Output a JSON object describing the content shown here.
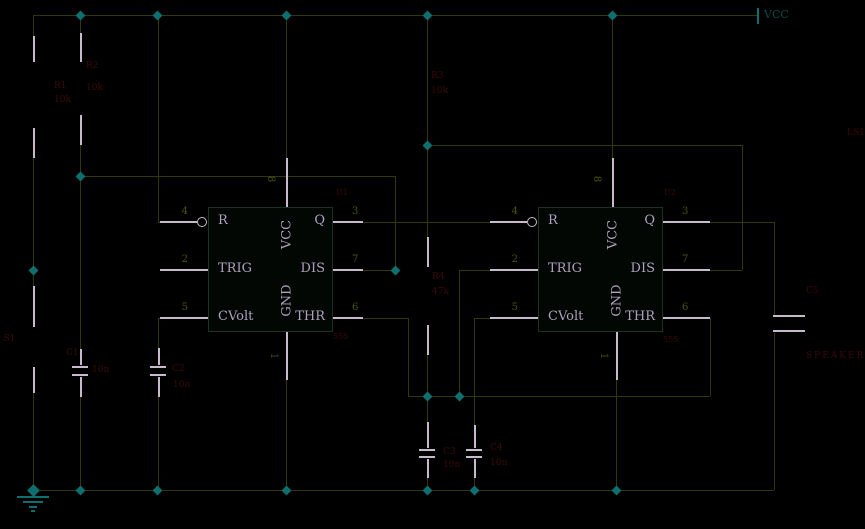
{
  "canvas": {
    "width": 865,
    "height": 529,
    "background": "#000000"
  },
  "colors": {
    "wire": "#2f3a06",
    "lead": "#c8b9cd",
    "teal": "#0f6e6e",
    "red": "#3c0a05",
    "num": "#4a5509",
    "pin_text": "#afa0be",
    "vcc_text": "#0a4b4b",
    "chip_border": "#193223",
    "chip_fill": "#020703"
  },
  "power": {
    "vcc_label": "VCC"
  },
  "chips": [
    {
      "ref": "U1",
      "value": "555",
      "x": 208,
      "y": 207,
      "w": 125,
      "h": 125,
      "left_pins": [
        {
          "num": "4",
          "name": "R",
          "y": 222
        },
        {
          "num": "2",
          "name": "TRIG",
          "y": 270
        },
        {
          "num": "5",
          "name": "CVolt",
          "y": 318
        }
      ],
      "right_pins": [
        {
          "num": "3",
          "name": "Q",
          "y": 222
        },
        {
          "num": "7",
          "name": "DIS",
          "y": 270
        },
        {
          "num": "6",
          "name": "THR",
          "y": 318
        }
      ],
      "top_pin": {
        "num": "8",
        "name": "VCC",
        "x": 286
      },
      "bottom_pin": {
        "num": "1",
        "name": "GND",
        "x": 286
      },
      "ref_pos": [
        336,
        189
      ],
      "value_pos": [
        333,
        333
      ]
    },
    {
      "ref": "U2",
      "value": "555",
      "x": 538,
      "y": 207,
      "w": 125,
      "h": 125,
      "left_pins": [
        {
          "num": "4",
          "name": "R",
          "y": 222
        },
        {
          "num": "2",
          "name": "TRIG",
          "y": 270
        },
        {
          "num": "5",
          "name": "CVolt",
          "y": 318
        }
      ],
      "right_pins": [
        {
          "num": "3",
          "name": "Q",
          "y": 222
        },
        {
          "num": "7",
          "name": "DIS",
          "y": 270
        },
        {
          "num": "6",
          "name": "THR",
          "y": 318
        }
      ],
      "top_pin": {
        "num": "8",
        "name": "VCC",
        "x": 612
      },
      "bottom_pin": {
        "num": "1",
        "name": "GND",
        "x": 616
      },
      "ref_pos": [
        664,
        189
      ],
      "value_pos": [
        663,
        336
      ]
    }
  ],
  "bubbles": [
    [
      202,
      222
    ],
    [
      532,
      222
    ]
  ],
  "segments": {
    "wire": [
      [
        33,
        15,
        757,
        15
      ],
      [
        33,
        15,
        33,
        36
      ],
      [
        33,
        158,
        33,
        286
      ],
      [
        33,
        393,
        33,
        490
      ],
      [
        80,
        15,
        80,
        33
      ],
      [
        80,
        145,
        80,
        349
      ],
      [
        80,
        397,
        80,
        490
      ],
      [
        80,
        176,
        395,
        176
      ],
      [
        395,
        176,
        395,
        270
      ],
      [
        158,
        15,
        158,
        222
      ],
      [
        158,
        222,
        160,
        222
      ],
      [
        158,
        318,
        160,
        318
      ],
      [
        158,
        318,
        158,
        348
      ],
      [
        158,
        397,
        158,
        490
      ],
      [
        286,
        15,
        286,
        158
      ],
      [
        286,
        380,
        286,
        490
      ],
      [
        427,
        15,
        427,
        237
      ],
      [
        427,
        355,
        427,
        422
      ],
      [
        427,
        478,
        427,
        490
      ],
      [
        427,
        145,
        742,
        145
      ],
      [
        742,
        145,
        742,
        270
      ],
      [
        710,
        270,
        742,
        270
      ],
      [
        363,
        222,
        490,
        222
      ],
      [
        363,
        270,
        395,
        270
      ],
      [
        363,
        318,
        408,
        318
      ],
      [
        408,
        318,
        408,
        396
      ],
      [
        408,
        396,
        427,
        396
      ],
      [
        427,
        396,
        710,
        396
      ],
      [
        710,
        318,
        710,
        396
      ],
      [
        459,
        270,
        490,
        270
      ],
      [
        459,
        270,
        459,
        396
      ],
      [
        474,
        318,
        490,
        318
      ],
      [
        474,
        318,
        474,
        425
      ],
      [
        474,
        478,
        474,
        490
      ],
      [
        612,
        15,
        612,
        158
      ],
      [
        616,
        380,
        616,
        490
      ],
      [
        710,
        222,
        774,
        222
      ],
      [
        774,
        222,
        774,
        315
      ],
      [
        774,
        333,
        774,
        490
      ],
      [
        33,
        490,
        774,
        490
      ]
    ],
    "lead": [
      [
        33,
        36,
        33,
        62
      ],
      [
        33,
        128,
        33,
        158
      ],
      [
        80,
        33,
        80,
        62
      ],
      [
        80,
        115,
        80,
        145
      ],
      [
        427,
        237,
        427,
        267
      ],
      [
        427,
        325,
        427,
        355
      ],
      [
        33,
        286,
        33,
        327
      ],
      [
        33,
        367,
        33,
        393
      ],
      [
        80,
        349,
        80,
        365
      ],
      [
        80,
        377,
        80,
        397
      ],
      [
        158,
        348,
        158,
        365
      ],
      [
        158,
        377,
        158,
        397
      ],
      [
        427,
        422,
        427,
        448
      ],
      [
        427,
        459,
        427,
        478
      ],
      [
        474,
        425,
        474,
        448
      ],
      [
        474,
        459,
        474,
        478
      ],
      [
        72,
        367,
        88,
        367
      ],
      [
        72,
        375,
        88,
        375
      ],
      [
        150,
        367,
        166,
        367
      ],
      [
        150,
        375,
        166,
        375
      ],
      [
        419,
        450,
        435,
        450
      ],
      [
        419,
        457,
        435,
        457
      ],
      [
        466,
        450,
        482,
        450
      ],
      [
        466,
        457,
        482,
        457
      ],
      [
        773,
        316,
        805,
        316
      ],
      [
        773,
        331,
        805,
        331
      ],
      [
        160,
        222,
        197,
        222
      ],
      [
        160,
        270,
        208,
        270
      ],
      [
        160,
        318,
        208,
        318
      ],
      [
        286,
        158,
        286,
        207
      ],
      [
        286,
        332,
        286,
        380
      ],
      [
        333,
        222,
        363,
        222
      ],
      [
        333,
        270,
        363,
        270
      ],
      [
        333,
        318,
        363,
        318
      ],
      [
        490,
        222,
        527,
        222
      ],
      [
        490,
        270,
        538,
        270
      ],
      [
        490,
        318,
        538,
        318
      ],
      [
        612,
        158,
        612,
        207
      ],
      [
        616,
        332,
        616,
        380
      ],
      [
        663,
        222,
        710,
        222
      ],
      [
        663,
        270,
        710,
        270
      ],
      [
        663,
        318,
        710,
        318
      ]
    ],
    "teal": [
      [
        757,
        8,
        757,
        24
      ],
      [
        33,
        490,
        33,
        497
      ],
      [
        17,
        497,
        49,
        497
      ],
      [
        23,
        502,
        43,
        502
      ],
      [
        29,
        507,
        37,
        507
      ],
      [
        31,
        511,
        35,
        511
      ]
    ]
  },
  "dots": [
    [
      80,
      15
    ],
    [
      157,
      15
    ],
    [
      286,
      15
    ],
    [
      427,
      15
    ],
    [
      612,
      15
    ],
    [
      33,
      270
    ],
    [
      80,
      176
    ],
    [
      395,
      270
    ],
    [
      427,
      145
    ],
    [
      427,
      396
    ],
    [
      459,
      396
    ],
    [
      33,
      490,
      9
    ],
    [
      80,
      490
    ],
    [
      157,
      490
    ],
    [
      286,
      490
    ],
    [
      427,
      490
    ],
    [
      474,
      490
    ],
    [
      616,
      490
    ]
  ],
  "labels": [
    {
      "t": "VCC",
      "x": 764,
      "y": 9,
      "c": "vcc_text",
      "fs": 11,
      "name": "vcc-terminal-label"
    },
    {
      "t": "R1",
      "x": 54,
      "y": 82,
      "name": "r1-ref"
    },
    {
      "t": "10k",
      "x": 54,
      "y": 96,
      "name": "r1-value"
    },
    {
      "t": "R2",
      "x": 86,
      "y": 62,
      "name": "r2-ref"
    },
    {
      "t": "10k",
      "x": 86,
      "y": 84,
      "name": "r2-value"
    },
    {
      "t": "R3",
      "x": 431,
      "y": 72,
      "name": "r3-ref"
    },
    {
      "t": "10k",
      "x": 431,
      "y": 87,
      "name": "r3-value"
    },
    {
      "t": "R4",
      "x": 432,
      "y": 273,
      "name": "r4-ref"
    },
    {
      "t": "47k",
      "x": 432,
      "y": 288,
      "name": "r4-value"
    },
    {
      "t": "PB S1",
      "x": -12,
      "y": 335,
      "name": "pushbutton-ref"
    },
    {
      "t": "C1",
      "x": 66,
      "y": 349,
      "name": "c1-ref"
    },
    {
      "t": "10n",
      "x": 92,
      "y": 366,
      "name": "c1-value"
    },
    {
      "t": "C2",
      "x": 172,
      "y": 365,
      "name": "c2-ref"
    },
    {
      "t": "10n",
      "x": 173,
      "y": 381,
      "name": "c2-value"
    },
    {
      "t": "C3",
      "x": 443,
      "y": 448,
      "name": "c3-ref"
    },
    {
      "t": "10n",
      "x": 443,
      "y": 461,
      "name": "c3-value"
    },
    {
      "t": "C4",
      "x": 490,
      "y": 444,
      "name": "c4-ref"
    },
    {
      "t": "10n",
      "x": 490,
      "y": 459,
      "name": "c4-value"
    },
    {
      "t": "C5",
      "x": 806,
      "y": 287,
      "name": "c5-ref"
    },
    {
      "t": "LS1",
      "x": 847,
      "y": 129,
      "name": "speaker-ref"
    },
    {
      "t": "SPEAKER",
      "x": 806,
      "y": 352,
      "ls": 2,
      "name": "speaker-value"
    }
  ]
}
